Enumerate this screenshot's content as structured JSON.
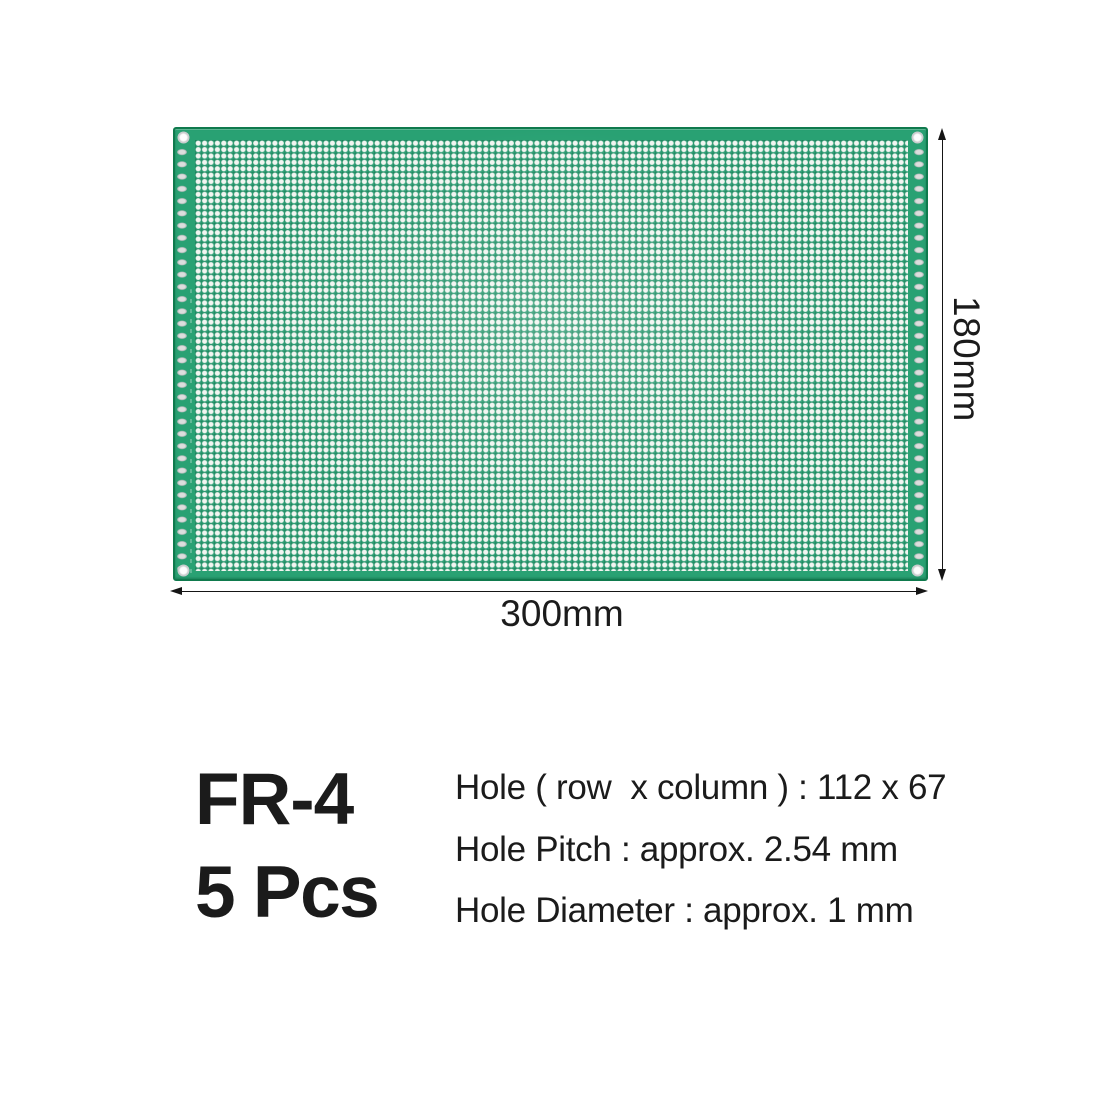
{
  "product": {
    "material_label": "FR-4",
    "quantity_label": "5 Pcs",
    "spec_lines": [
      "Hole ( row  x column ) : 112 x 67",
      "Hole Pitch : approx. 2.54 mm",
      "Hole Diameter : approx. 1 mm"
    ]
  },
  "dimensions": {
    "width_label": "300mm",
    "height_label": "180mm"
  },
  "board": {
    "hole_rows": "112",
    "hole_columns": "67",
    "hole_pitch_mm": "2.54",
    "hole_diameter_mm": "1",
    "colors": {
      "solder_mask_green": "#29a173",
      "field_green": "#31a379",
      "board_edge_green": "#0f7a4d",
      "hole_fill_white": "#f2f5f1",
      "edge_pad_silver": "#c6c9ca",
      "annotation_black": "#151515",
      "text_black": "#1b1b1b",
      "background_white": "#ffffff"
    }
  }
}
